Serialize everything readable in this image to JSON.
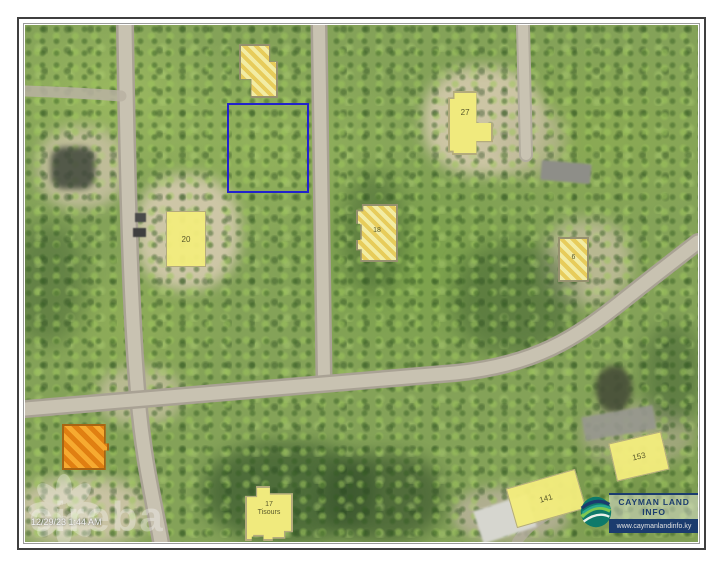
{
  "map": {
    "date_stamp": "12/29/23 1:44 AM",
    "watermark_text": "cireba",
    "parcels": {
      "p27": {
        "label": "27"
      },
      "p20": {
        "label": "20"
      },
      "p18": {
        "label": "18"
      },
      "p6": {
        "label": "6"
      },
      "p17": {
        "label": "17",
        "name": "Tisours"
      },
      "p141": {
        "label": "141"
      },
      "p153": {
        "label": "153"
      },
      "p154": {
        "label": "154"
      }
    }
  },
  "logo": {
    "title": "CAYMAN LAND INFO",
    "url": "www.caymanlandinfo.ky"
  },
  "colors": {
    "parcel_yellow": "#f3ec7d",
    "hatch_gold": "#ecd25e",
    "highlight_orange": "#f09a1e",
    "selection_blue": "#2222cc",
    "logo_navy": "#1b3c6e",
    "road_gray": "#c8c2b1"
  }
}
